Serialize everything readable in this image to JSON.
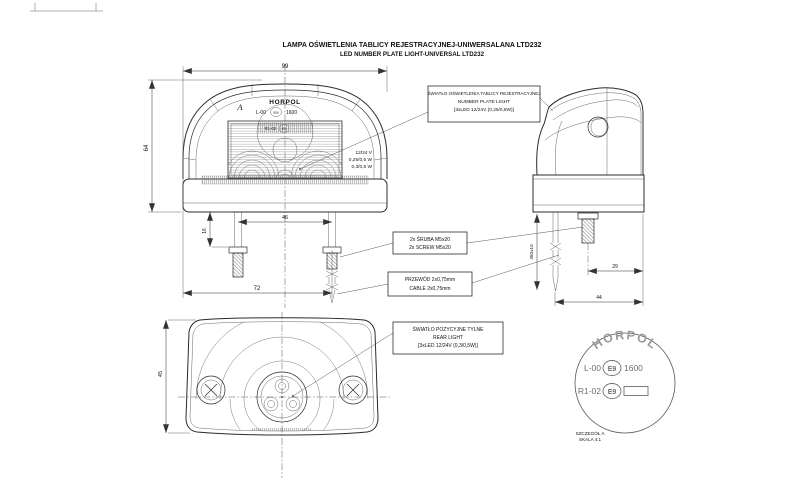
{
  "title": {
    "line1": "LAMPA OŚWIETLENIA TABLICY REJESTRACYJNEJ-UNIWERSALANA LTD232",
    "line2": "LED NUMBER PLATE LIGHT-UNIVERSAL LTD232"
  },
  "marking": {
    "brand": "HORPOL",
    "row1_prefix": "L-00",
    "e_mark": "E9",
    "row1_number": "1600",
    "row2_prefix": "R1-02",
    "detail_marker": "A"
  },
  "front_view": {
    "ratings": {
      "voltage": "12/24 V",
      "power_plate": "0,25/0,5 W",
      "power_rear": "0,3/0,5 W"
    },
    "dims": {
      "width": "99",
      "hole_spacing": "46",
      "base_width": "72",
      "screw_length": "16",
      "height": "64"
    }
  },
  "side_view": {
    "dims": {
      "cable_length": "450±10",
      "screw_offset": "29",
      "depth": "44"
    }
  },
  "bottom_view": {
    "dims": {
      "height": "45"
    }
  },
  "detail_view": {
    "caption_line1": "SZCZEGÓŁ A",
    "caption_line2": "SKALA 4:1"
  },
  "callouts": {
    "number_plate_light": {
      "line1": "ŚWIATŁO OŚWIETLENIA TABLICY REJESTRACYJNEJ",
      "line2": "NUMBER PLATE LIGHT",
      "line3": "[3xLED 12/24V (0,25/0,5W)]"
    },
    "screws": {
      "line1": "2x ŚRUBA M5x20",
      "line2": "2x SCREW M5x20"
    },
    "cable": {
      "line1": "PRZEWÓD 2x0,75mm",
      "line2": "CABLE 2x0,75mm"
    },
    "rear_light": {
      "line1": "ŚWIATŁO POZYCYJNE TYLNE",
      "line2": "REAR LIGHT",
      "line3": "[3xLED 12/24V (0,3/0,5W)]"
    }
  },
  "colors": {
    "line": "#2b2b2b",
    "thin_line": "#555555",
    "hatch": "#8a8a8a",
    "detail_text": "#6e6e6e",
    "background": "#ffffff"
  }
}
